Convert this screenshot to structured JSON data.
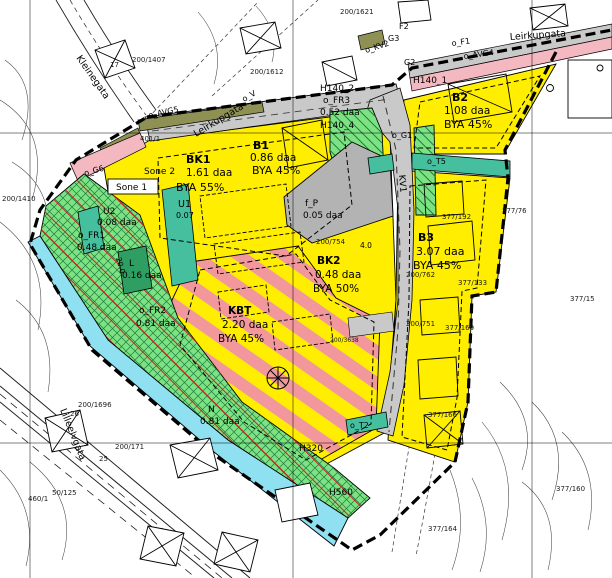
{
  "map": {
    "kind": "zoning-plan-map",
    "colors": {
      "residential_yellow": "#ffee00",
      "green_area": "#7de382",
      "green_dark": "#2f9e63",
      "nature_cyan": "#8fe1f2",
      "teal_utility": "#46bf9f",
      "pink_strip": "#f4b8c0",
      "stripe_pink": "#f2989d",
      "road_gray": "#c9c9c9",
      "parking_gray": "#b3b3b3",
      "olive_strip": "#8e9054",
      "hatch_green": "#1d7a42",
      "hatch_red": "#cc2222"
    },
    "zones": [
      {
        "code": "BK1",
        "sone": "Sone 2",
        "area": "1.61 daa",
        "bya": "BYA 55%"
      },
      {
        "code": "B1",
        "area": "0.86 daa",
        "bya": "BYA 45%"
      },
      {
        "code": "B2",
        "area": "1.08 daa",
        "bya": "BYA 45%",
        "hazard": "H140_1"
      },
      {
        "code": "B3",
        "area": "3.07 daa",
        "bya": "BYA 45%"
      },
      {
        "code": "BK2",
        "area": "0.48 daa",
        "bya": "BYA 50%"
      },
      {
        "code": "KBT",
        "area": "2.20 daa",
        "bya": "BYA 45%"
      },
      {
        "code": "f_P",
        "area": "0.05 daa"
      },
      {
        "code": "U1",
        "area": "0.07"
      },
      {
        "code": "U2",
        "area": "0.08 daa"
      },
      {
        "code": "o_FR1",
        "area": "0.48 daa"
      },
      {
        "code": "o_FR2",
        "area": "0.81 daa"
      },
      {
        "code": "o_FR3",
        "area": "0.52 daa",
        "hazard": "H140_2"
      },
      {
        "code": "L",
        "area": "0.16 daa"
      },
      {
        "code": "N",
        "area": "0.81 daa"
      }
    ],
    "streets": [
      "Leirkupgata",
      "Kleinegata",
      "Lilleelvgata"
    ],
    "annotations": [
      {
        "n": "street-leirkupgata-top",
        "t": "Leirkupgata",
        "x": 510,
        "y": 40,
        "r": -4,
        "s": 9.5
      },
      {
        "n": "street-leirkupgata-diag",
        "t": "Leirkupgata",
        "x": 196,
        "y": 137,
        "r": -31,
        "s": 9.5
      },
      {
        "n": "street-kleinegata",
        "t": "Kleinegata",
        "x": 76,
        "y": 58,
        "r": 55,
        "s": 9.5
      },
      {
        "n": "street-lilleelvgata",
        "t": "Lilleelvgata",
        "x": 60,
        "y": 410,
        "r": 68,
        "s": 9.5
      },
      {
        "n": "zone-bk1-code",
        "t": "BK1",
        "x": 186,
        "y": 163,
        "s": 11,
        "b": 1
      },
      {
        "n": "zone-bk1-sone2",
        "t": "Sone 2",
        "x": 144,
        "y": 174,
        "s": 9
      },
      {
        "n": "zone-bk1-area",
        "t": "1.61 daa",
        "x": 186,
        "y": 176,
        "s": 10.5
      },
      {
        "n": "zone-bk1-bya",
        "t": "BYA 55%",
        "x": 176,
        "y": 191,
        "s": 11
      },
      {
        "n": "zone-u1-code",
        "t": "U1",
        "x": 178,
        "y": 207,
        "s": 9.5
      },
      {
        "n": "zone-u1-area",
        "t": "0.07",
        "x": 176,
        "y": 218,
        "s": 8
      },
      {
        "n": "sone1-label",
        "t": "Sone 1",
        "x": 116,
        "y": 190,
        "s": 9
      },
      {
        "n": "zone-b1-code",
        "t": "B1",
        "x": 253,
        "y": 149,
        "s": 11,
        "b": 1
      },
      {
        "n": "zone-b1-area",
        "t": "0.86 daa",
        "x": 250,
        "y": 161,
        "s": 10.5
      },
      {
        "n": "zone-b1-bya",
        "t": "BYA 45%",
        "x": 252,
        "y": 174,
        "s": 11
      },
      {
        "n": "zone-b2-code",
        "t": "B2",
        "x": 452,
        "y": 101,
        "s": 11,
        "b": 1
      },
      {
        "n": "zone-b2-area",
        "t": "1.08 daa",
        "x": 444,
        "y": 114,
        "s": 10.5
      },
      {
        "n": "zone-b2-bya",
        "t": "BYA 45%",
        "x": 444,
        "y": 128,
        "s": 11
      },
      {
        "n": "hazard-h140-1",
        "t": "H140_1",
        "x": 413,
        "y": 83,
        "s": 9
      },
      {
        "n": "zone-b3-code",
        "t": "B3",
        "x": 418,
        "y": 241,
        "s": 11,
        "b": 1
      },
      {
        "n": "zone-b3-area",
        "t": "3.07 daa",
        "x": 416,
        "y": 255,
        "s": 11
      },
      {
        "n": "zone-b3-bya",
        "t": "BYA 45%",
        "x": 413,
        "y": 269,
        "s": 11
      },
      {
        "n": "zone-bk2-code",
        "t": "BK2",
        "x": 317,
        "y": 264,
        "s": 10.5,
        "b": 1
      },
      {
        "n": "zone-bk2-area",
        "t": "0.48 daa",
        "x": 315,
        "y": 278,
        "s": 10.5
      },
      {
        "n": "zone-bk2-bya",
        "t": "BYA 50%",
        "x": 313,
        "y": 292,
        "s": 10.5
      },
      {
        "n": "zone-kbt-code",
        "t": "KBT",
        "x": 228,
        "y": 314,
        "s": 10.5,
        "b": 1
      },
      {
        "n": "zone-kbt-area",
        "t": "2.20 daa",
        "x": 222,
        "y": 328,
        "s": 10.5
      },
      {
        "n": "zone-kbt-bya",
        "t": "BYA 45%",
        "x": 218,
        "y": 342,
        "s": 10.5
      },
      {
        "n": "zone-fp-code",
        "t": "f_P",
        "x": 305,
        "y": 206,
        "s": 9
      },
      {
        "n": "zone-fp-area",
        "t": "0.05 daa",
        "x": 303,
        "y": 218,
        "s": 9
      },
      {
        "n": "zone-u2-code",
        "t": "U2",
        "x": 103,
        "y": 214,
        "s": 9
      },
      {
        "n": "zone-u2-area",
        "t": "0.08 daa",
        "x": 97,
        "y": 225,
        "s": 9
      },
      {
        "n": "zone-fr1-code",
        "t": "o_FR1",
        "x": 78,
        "y": 238,
        "s": 9
      },
      {
        "n": "zone-fr1-area",
        "t": "0.48 daa",
        "x": 77,
        "y": 250,
        "s": 9
      },
      {
        "n": "zone-l-code",
        "t": "L",
        "x": 129,
        "y": 266,
        "s": 9
      },
      {
        "n": "zone-l-area",
        "t": "0.16 daa",
        "x": 122,
        "y": 278,
        "s": 9
      },
      {
        "n": "zone-fr2-code",
        "t": "o_FR2",
        "x": 139,
        "y": 313,
        "s": 9
      },
      {
        "n": "zone-fr2-area",
        "t": "0.81 daa",
        "x": 136,
        "y": 326,
        "s": 9
      },
      {
        "n": "zone-n-code",
        "t": "N",
        "x": 208,
        "y": 412,
        "s": 9
      },
      {
        "n": "zone-n-area",
        "t": "0.81 daa",
        "x": 200,
        "y": 424,
        "s": 9
      },
      {
        "n": "hazard-h140-2",
        "t": "H140_2",
        "x": 320,
        "y": 91,
        "s": 9
      },
      {
        "n": "zone-fr3-code",
        "t": "o_FR3",
        "x": 323,
        "y": 103,
        "s": 9
      },
      {
        "n": "zone-fr3-area",
        "t": "0.52 daa",
        "x": 320,
        "y": 115,
        "s": 9
      },
      {
        "n": "hazard-h140-4",
        "t": "H140_4",
        "x": 320,
        "y": 128,
        "s": 9
      },
      {
        "n": "hazard-h320",
        "t": "H320",
        "x": 299,
        "y": 451,
        "s": 9
      },
      {
        "n": "hazard-h560",
        "t": "H560",
        "x": 329,
        "y": 495,
        "s": 9
      },
      {
        "n": "strip-avg5",
        "t": "o_AVG5",
        "x": 149,
        "y": 118,
        "r": -12,
        "s": 8
      },
      {
        "n": "strip-g6",
        "t": "o_G6",
        "x": 85,
        "y": 176,
        "r": -16,
        "s": 8
      },
      {
        "n": "strip-f1",
        "t": "o_F1",
        "x": 452,
        "y": 46,
        "r": -8,
        "s": 8
      },
      {
        "n": "strip-avg4",
        "t": "o_AVG4",
        "x": 464,
        "y": 59,
        "r": -8,
        "s": 8
      },
      {
        "n": "road-kv2",
        "t": "o_KV2",
        "x": 366,
        "y": 53,
        "r": -18,
        "s": 8
      },
      {
        "n": "strip-f2",
        "t": "F2",
        "x": 399,
        "y": 29,
        "s": 8
      },
      {
        "n": "strip-g3",
        "t": "G3",
        "x": 388,
        "y": 41,
        "s": 8
      },
      {
        "n": "strip-g2",
        "t": "G2",
        "x": 404,
        "y": 65,
        "s": 8
      },
      {
        "n": "strip-g1",
        "t": "o_G1",
        "x": 392,
        "y": 138,
        "s": 8
      },
      {
        "n": "strip-t5",
        "t": "o_T5",
        "x": 427,
        "y": 164,
        "s": 8
      },
      {
        "n": "strip-t2",
        "t": "o_T2",
        "x": 350,
        "y": 428,
        "s": 8
      },
      {
        "n": "road-kv1",
        "t": "KV1",
        "x": 399,
        "y": 175,
        "r": 85,
        "s": 9
      },
      {
        "n": "strip-v",
        "t": "o_V",
        "x": 244,
        "y": 102,
        "r": -30,
        "s": 8
      },
      {
        "n": "dim-20",
        "t": "20.0",
        "x": 116,
        "y": 258,
        "r": 75,
        "s": 7.5
      },
      {
        "n": "dim-4",
        "t": "4.0",
        "x": 360,
        "y": 248,
        "s": 7.5
      },
      {
        "n": "parcel-401-1",
        "t": "401/1",
        "x": 140,
        "y": 141,
        "s": 7,
        "c": 1
      },
      {
        "n": "parcel-200-1407",
        "t": "200/1407",
        "x": 132,
        "y": 62,
        "s": 7,
        "c": 1
      },
      {
        "n": "parcel-200-1410",
        "t": "200/1410",
        "x": 2,
        "y": 201,
        "s": 7,
        "c": 1
      },
      {
        "n": "parcel-200-1621",
        "t": "200/1621",
        "x": 340,
        "y": 14,
        "s": 7,
        "c": 1
      },
      {
        "n": "parcel-200-1612",
        "t": "200/1612",
        "x": 250,
        "y": 74,
        "s": 7,
        "c": 1
      },
      {
        "n": "parcel-377-76",
        "t": "377/76",
        "x": 502,
        "y": 213,
        "s": 7,
        "c": 1
      },
      {
        "n": "parcel-377-192",
        "t": "377/192",
        "x": 442,
        "y": 219,
        "s": 7,
        "c": 1
      },
      {
        "n": "parcel-200-754",
        "t": "200/754",
        "x": 316,
        "y": 244,
        "s": 7,
        "c": 1
      },
      {
        "n": "parcel-200-762",
        "t": "200/762",
        "x": 406,
        "y": 277,
        "s": 7,
        "c": 1
      },
      {
        "n": "parcel-377-133",
        "t": "377/133",
        "x": 458,
        "y": 285,
        "s": 7,
        "c": 1
      },
      {
        "n": "parcel-200-751",
        "t": "200/751",
        "x": 406,
        "y": 326,
        "s": 7,
        "c": 1
      },
      {
        "n": "parcel-377-169",
        "t": "377/169",
        "x": 445,
        "y": 330,
        "s": 7,
        "c": 1
      },
      {
        "n": "parcel-377-166",
        "t": "377/166",
        "x": 428,
        "y": 417,
        "s": 7,
        "c": 1
      },
      {
        "n": "parcel-377-15",
        "t": "377/15",
        "x": 570,
        "y": 301,
        "s": 7,
        "c": 1
      },
      {
        "n": "parcel-377-160",
        "t": "377/160",
        "x": 556,
        "y": 491,
        "s": 7,
        "c": 1
      },
      {
        "n": "parcel-377-164",
        "t": "377/164",
        "x": 428,
        "y": 531,
        "s": 7,
        "c": 1
      },
      {
        "n": "parcel-200-1696",
        "t": "200/1696",
        "x": 78,
        "y": 407,
        "s": 7,
        "c": 1
      },
      {
        "n": "parcel-200-171",
        "t": "200/171",
        "x": 115,
        "y": 449,
        "s": 7,
        "c": 1
      },
      {
        "n": "parcel-460-1",
        "t": "460/1",
        "x": 28,
        "y": 501,
        "s": 7,
        "c": 1
      },
      {
        "n": "parcel-50-125",
        "t": "50/125",
        "x": 52,
        "y": 495,
        "s": 7,
        "c": 1
      },
      {
        "n": "parcel-200-3638",
        "t": "200/3638",
        "x": 330,
        "y": 342,
        "s": 6,
        "c": 1
      },
      {
        "n": "house-number-26",
        "t": "26",
        "x": 70,
        "y": 416,
        "s": 7,
        "c": 1
      },
      {
        "n": "house-number-25",
        "t": "25",
        "x": 99,
        "y": 461,
        "s": 7,
        "c": 1
      },
      {
        "n": "house-number-17",
        "t": "17",
        "x": 110,
        "y": 67,
        "s": 7,
        "c": 1
      }
    ]
  }
}
